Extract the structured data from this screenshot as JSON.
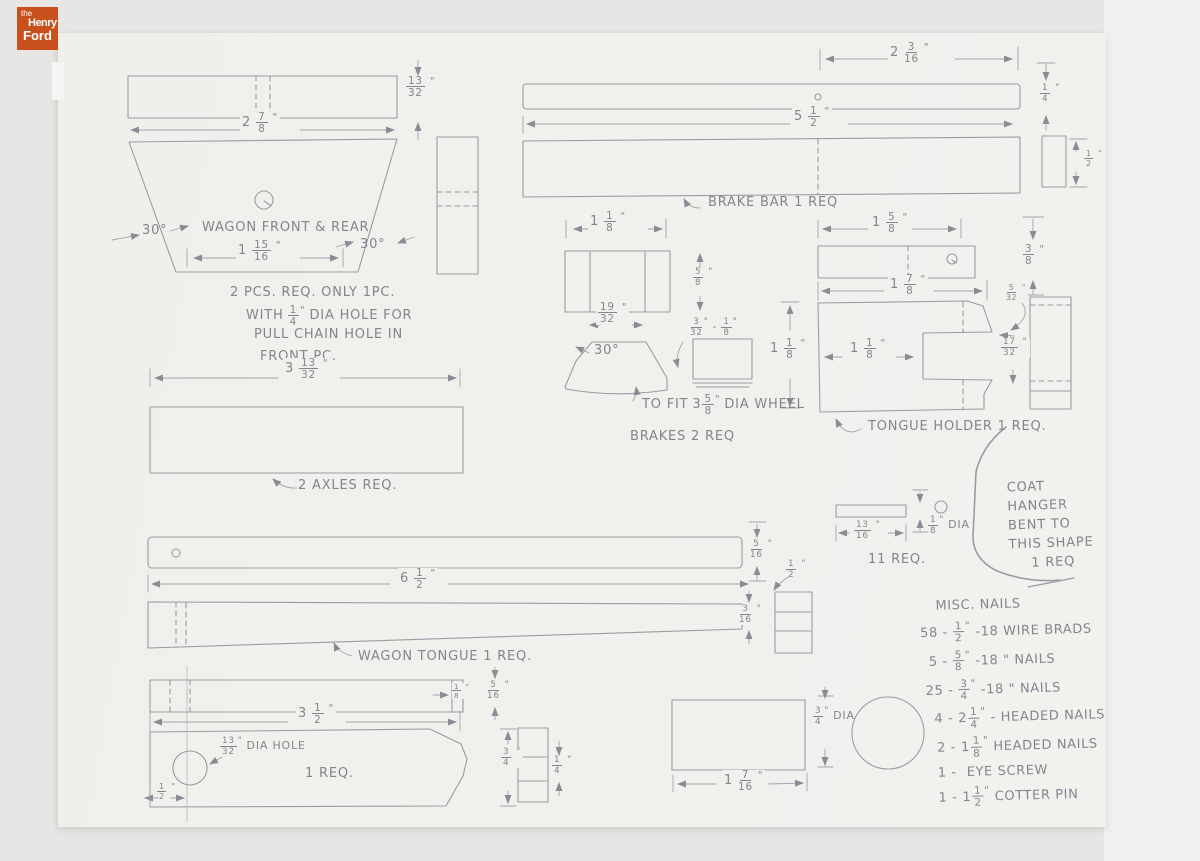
{
  "logo": {
    "the": "the",
    "henry": "Henry",
    "ford": "Ford"
  },
  "colors": {
    "logo_bg": "#c8501d",
    "paper": "#f1f0ec",
    "pencil": "#86838e"
  },
  "front_rear": {
    "dim_width": "2 7/8\"",
    "dim_thickness": "13/32\"",
    "angle_left": "30°",
    "angle_right": "30°",
    "name": "WAGON FRONT & REAR",
    "dim_bottom": "1 15/16\"",
    "note_l1": "2 PCS. REQ. ONLY 1PC.",
    "note_l2a": "WITH",
    "note_l2frac": "1/4\"",
    "note_l2b": "DIA HOLE FOR",
    "note_l3": "PULL CHAIN HOLE IN",
    "note_l4": "FRONT PC."
  },
  "axle": {
    "dim_length": "3 13/32\"",
    "label": "2 AXLES REQ."
  },
  "brake_bar": {
    "dim_end_offset": "2 3/16\"",
    "dim_length": "5 1/2\"",
    "label": "BRAKE BAR   1 REQ",
    "dim_thickness": "1/4\"",
    "dim_stock": "1/2\""
  },
  "brakes": {
    "dim_width": "1 1/8\"",
    "dim_height": "5/8\"",
    "dim_base": "19/32\"",
    "angle": "30°",
    "pad_dim_a": "3/32\"",
    "pad_dash": "-",
    "pad_dim_b": "1/8\"",
    "fit_pre": "TO FIT",
    "fit_dim": "3 5/8\"",
    "fit_post": "DIA WHEEL",
    "label": "BRAKES  2 REQ",
    "dim_height2": "1 1/8\""
  },
  "tongue_holder": {
    "dim_top": "1 5/8\"",
    "dim_thickness": "3/8\"",
    "dim_length": "1 7/8\"",
    "dim_inner": "1 1/8\"",
    "dim_small": "5/32\"",
    "dim_notch": "17/32\"",
    "label": "TONGUE HOLDER   1 REQ."
  },
  "rods": {
    "dim_length": "13/16\"",
    "dim_dia": "1/8\"",
    "dia_text": "DIA",
    "label": "11 REQ."
  },
  "coat_hanger": {
    "l1": "COAT",
    "l2": "HANGER",
    "l3": "BENT TO",
    "l4": "THIS SHAPE",
    "l5": "1 REQ"
  },
  "wagon_tongue": {
    "dim_length": "6 1/2\"",
    "label": "WAGON TONGUE   1 REQ.",
    "dim_thick1": "5/16\"",
    "dim_stock": "1/2\"",
    "dim_thick2": "3/16\""
  },
  "handle": {
    "dim_notch": "1/8\"",
    "dim_thick": "5/16\"",
    "dim_length": "3 1/2\"",
    "hole_dim": "13/32\"",
    "hole_text": "DIA HOLE",
    "label": "1 REQ.",
    "dim_offset": "1/2\"",
    "dim_end": "3/4\"",
    "dim_mid": "1/4\""
  },
  "block": {
    "dim_dia": "3/4\"",
    "dia_text": "DIA",
    "dim_length": "1 7/16\""
  },
  "nails": {
    "title": "MISC. NAILS",
    "items": [
      {
        "pre": "58 -",
        "frac": "1/2\"",
        "post": "-18 WIRE BRADS"
      },
      {
        "pre": "5 -",
        "frac": "5/8\"",
        "post": "-18  \" NAILS"
      },
      {
        "pre": "25 -",
        "frac": "3/4\"",
        "post": "-18  \" NAILS"
      },
      {
        "pre": "4 -",
        "frac": "2 1/4\"",
        "post": "-  HEADED NAILS"
      },
      {
        "pre": "2 -",
        "frac": "1 1/8\"",
        "post": "HEADED NAILS"
      },
      {
        "pre": "1 -",
        "frac": "",
        "post": "EYE SCREW"
      },
      {
        "pre": "1 -",
        "frac": "1 1/2\"",
        "post": "COTTER PIN"
      }
    ]
  }
}
